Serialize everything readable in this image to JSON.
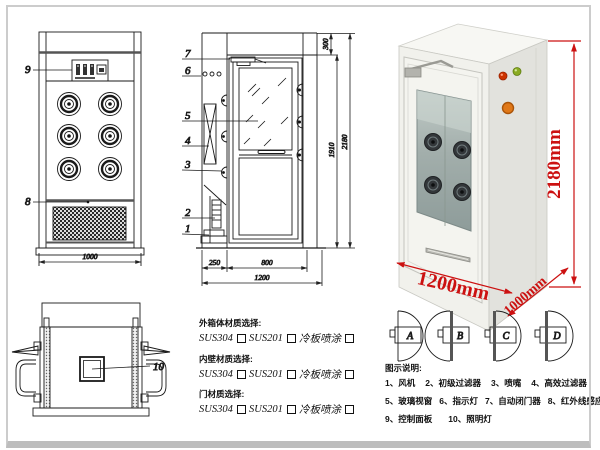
{
  "front_view": {
    "label_control_panel": "9",
    "label_grille": "8",
    "dim_width": "1000"
  },
  "section_view": {
    "labels": {
      "l1": "1",
      "l2": "2",
      "l3": "3",
      "l4": "4",
      "l5": "5",
      "l6": "6",
      "l7": "7"
    },
    "dims": {
      "top": "300",
      "door_height": "1910",
      "total_height": "2180",
      "left": "250",
      "door_width": "800",
      "total_width": "1200"
    }
  },
  "top_view": {
    "label_lamp": "10"
  },
  "photo": {
    "dims": {
      "height": "2180mm",
      "width": "1200mm",
      "depth": "1000mm"
    }
  },
  "door_options": {
    "a": "A",
    "b": "B",
    "c": "C",
    "d": "D"
  },
  "materials": {
    "groups": [
      {
        "title": "外箱体材质选择:",
        "options": [
          {
            "label": "SUS304"
          },
          {
            "label": "SUS201"
          },
          {
            "label": "冷板喷涂"
          }
        ]
      },
      {
        "title": "内壁材质选择:",
        "options": [
          {
            "label": "SUS304"
          },
          {
            "label": "SUS201"
          },
          {
            "label": "冷板喷涂"
          }
        ]
      },
      {
        "title": "门材质选择:",
        "options": [
          {
            "label": "SUS304"
          },
          {
            "label": "SUS201"
          },
          {
            "label": "冷板喷涂"
          }
        ]
      }
    ]
  },
  "legend": {
    "title": "图示说明:",
    "rows": [
      [
        "1、风机",
        "2、初级过滤器",
        "3、喷嘴",
        "4、高效过滤器"
      ],
      [
        "5、玻璃视窗",
        "6、指示灯",
        "7、自动闭门器",
        "8、红外线感应器"
      ],
      [
        "9、控制面板",
        "10、照明灯"
      ]
    ]
  },
  "colors": {
    "dim_red": "#cc1111",
    "line": "#1a1a1a"
  }
}
